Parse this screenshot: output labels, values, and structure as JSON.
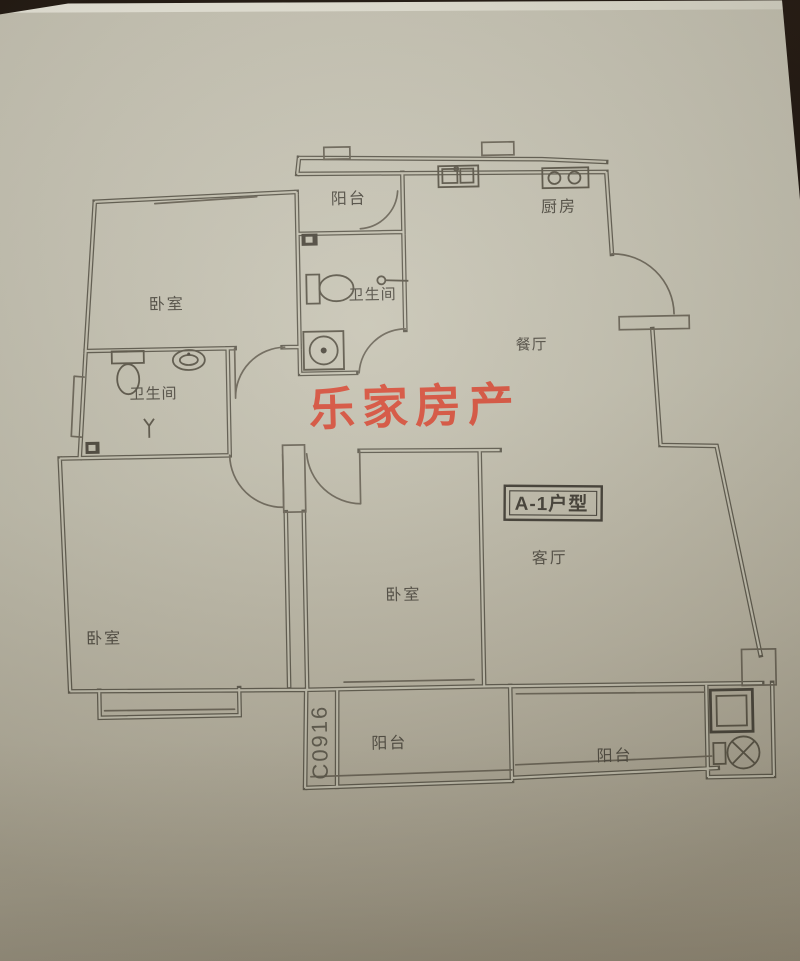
{
  "photo": {
    "background_color": "#1a110a",
    "paper_color": "#c5c2b1",
    "pencil_color": "#5d594c",
    "watermark_color": "#d8452f"
  },
  "watermark": {
    "text": "乐家房产"
  },
  "unit_type": {
    "text": "A-1户型"
  },
  "plan_code": {
    "text": "C0916"
  },
  "rooms": {
    "balcony_top": "阳台",
    "kitchen": "厨房",
    "bathroom_top": "卫生间",
    "bedroom_top_left": "卧室",
    "bathroom_left": "卫生间",
    "dining": "餐厅",
    "living": "客厅",
    "bedroom_middle": "卧室",
    "bedroom_bottom_left": "卧室",
    "balcony_bottom_middle": "阳台",
    "balcony_bottom_right": "阳台"
  }
}
